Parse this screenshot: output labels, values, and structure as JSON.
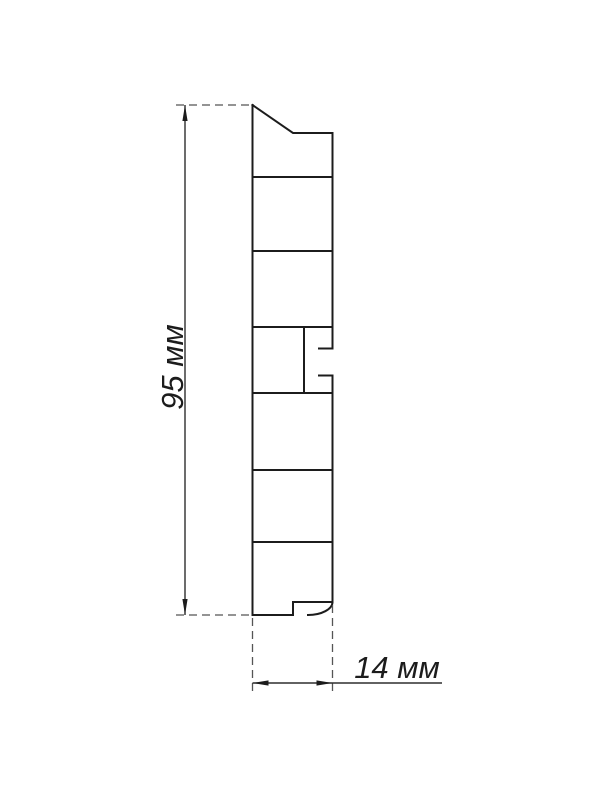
{
  "drawing": {
    "kind": "profile-cross-section",
    "labels": {
      "height": "95 мм",
      "width": "14 мм"
    },
    "colors": {
      "profile_line": "#1c1c1c",
      "dimension_line": "#2e2e2e",
      "extension_line": "#555555",
      "arrow_fill": "#1c1c1c",
      "text": "#1c1c1c",
      "background": "#ffffff"
    }
  }
}
